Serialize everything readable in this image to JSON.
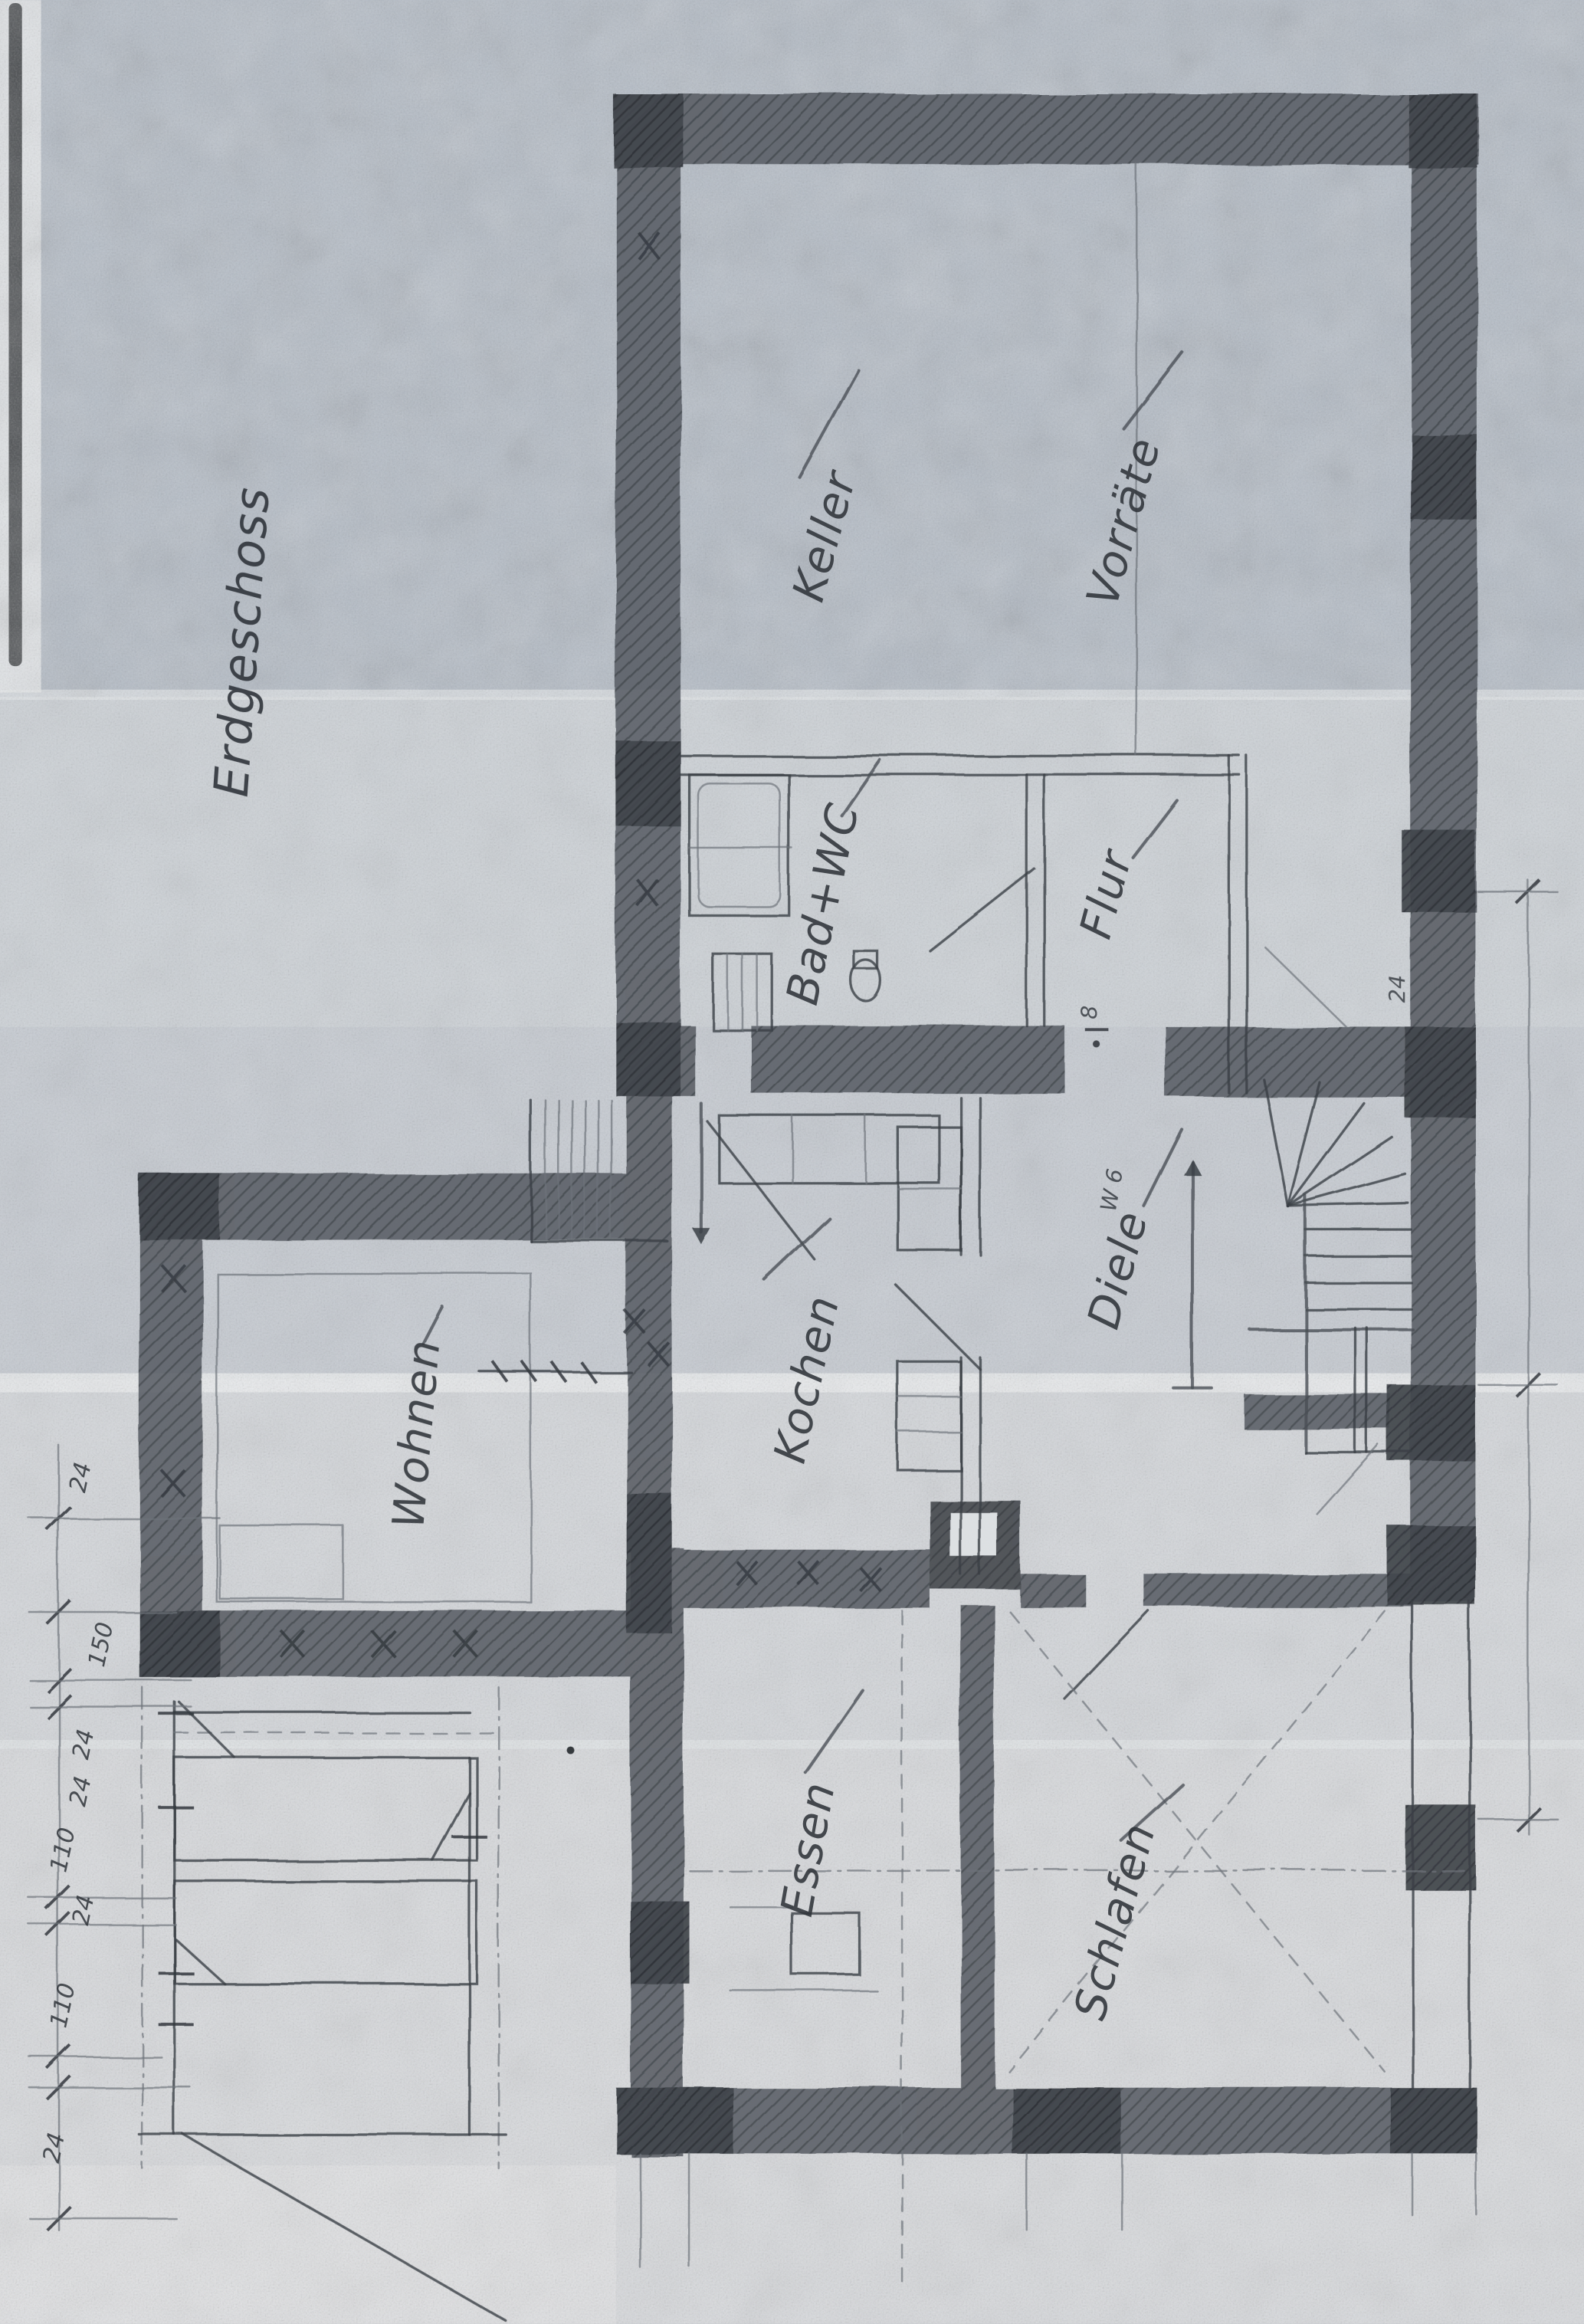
{
  "document": {
    "floor_label": "Erdgeschoss"
  },
  "rooms": [
    {
      "id": "keller",
      "label": "Keller"
    },
    {
      "id": "vorraete",
      "label": "Vorräte"
    },
    {
      "id": "bad-wc",
      "label": "Bad+WC"
    },
    {
      "id": "flur",
      "label": "Flur"
    },
    {
      "id": "kochen",
      "label": "Kochen"
    },
    {
      "id": "wohnen",
      "label": "Wohnen"
    },
    {
      "id": "diele",
      "label": "Diele"
    },
    {
      "id": "essen",
      "label": "Essen"
    },
    {
      "id": "schlafen",
      "label": "Schlafen"
    }
  ],
  "dimensions": {
    "left_chain": [
      "24",
      "150",
      "24",
      "24",
      "110",
      "24",
      "110",
      "24"
    ],
    "wall_thickness_note": "24"
  },
  "annotations": {
    "stair_note": "W 6",
    "door_width_note": "8"
  },
  "colors": {
    "paper_top_band": "#b4bcc6",
    "paper_light_band": "#d4d7db",
    "pencil": "#3a3f45",
    "wall_fill": "#4b5056"
  }
}
